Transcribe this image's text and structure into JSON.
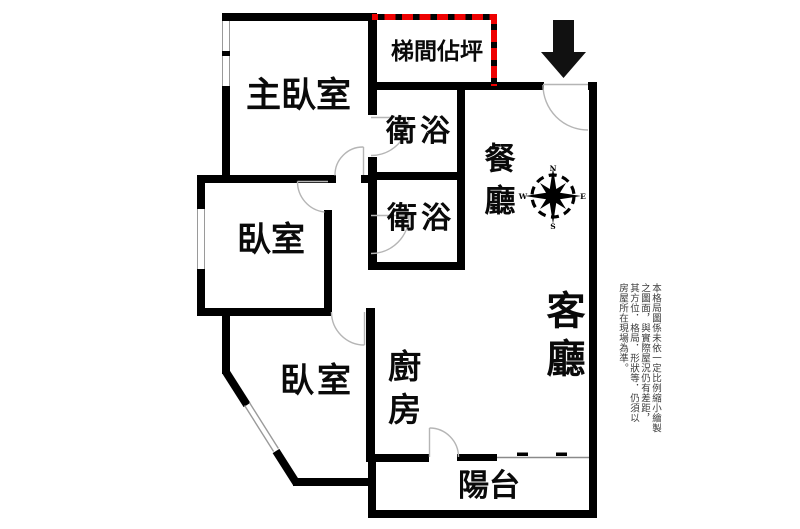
{
  "rooms": {
    "master_bedroom": {
      "label": "主臥室"
    },
    "bedroom_1": {
      "label": "臥室"
    },
    "bedroom_2": {
      "label": "臥室"
    },
    "bathroom_1": {
      "label": "衛浴"
    },
    "bathroom_2": {
      "label": "衛浴"
    },
    "stairwell": {
      "label": "梯間佔坪"
    },
    "dining_room": {
      "label": "餐廳"
    },
    "living_room": {
      "label": "客廳"
    },
    "kitchen": {
      "label": "廚房"
    },
    "balcony": {
      "label": "陽台"
    }
  },
  "compass": {
    "north": "N",
    "south": "S",
    "east": "E",
    "west": "W"
  },
  "disclaimer": {
    "line_1": "本格局圖係未依一定比例縮小繪製",
    "line_2": "之圖面，與實際屋況仍有差距，",
    "line_3": "其方位．格局．形狀等．仍須以",
    "line_4": "房屋所在現場為準。"
  },
  "colors": {
    "wall": "#000000",
    "stairwell_outline": "#ee0000",
    "window_line": "#9a9a9a",
    "door_line": "#b5b5b5",
    "arrow": "#111111"
  }
}
